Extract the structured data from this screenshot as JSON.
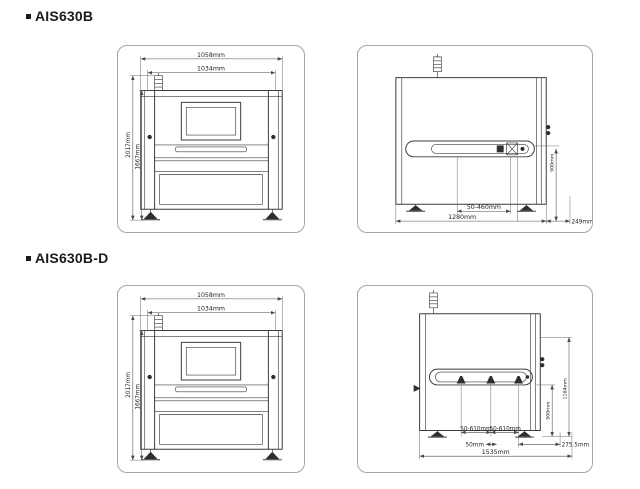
{
  "colors": {
    "line": "#3c3c3c",
    "panel_border": "#a6a6a6",
    "text": "#222222",
    "background": "#ffffff"
  },
  "machine1": {
    "title": "AIS630B",
    "front": {
      "w_outer": "1058mm",
      "w_inner": "1034mm",
      "h_outer": "2017mm",
      "h_inner": "1667mm"
    },
    "side": {
      "board_range": "50-460mm",
      "depth": "1280mm",
      "rear": "249mm",
      "conveyor_height": "900mm"
    }
  },
  "machine2": {
    "title": "AIS630B-D",
    "front": {
      "w_outer": "1058mm",
      "w_inner": "1034mm",
      "h_outer": "2017mm",
      "h_inner": "1667mm"
    },
    "side": {
      "board_range_left": "50-610mm",
      "board_range_right": "50-610mm",
      "rail_width": "50mm",
      "depth": "1535mm",
      "rear": "275.5mm",
      "conveyor_height": "900mm",
      "total_height": "1164mm"
    }
  }
}
